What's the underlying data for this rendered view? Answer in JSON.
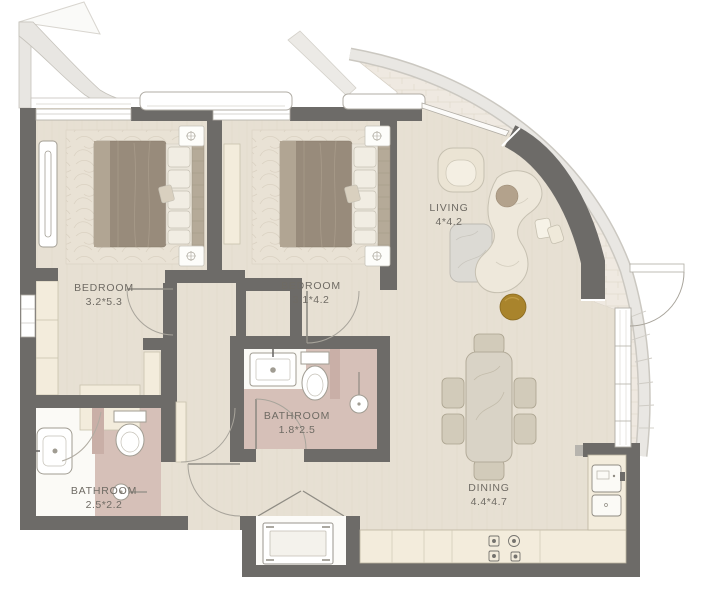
{
  "title": "Two-bedroom apartment floor plan",
  "rooms": {
    "bedroom1": {
      "label": "BEDROOM",
      "dims": "3.2*5.3"
    },
    "bedroom2": {
      "label": "BEDROOM",
      "dims": "3.1*4.2"
    },
    "living": {
      "label": "LIVING",
      "dims": "4*4.2"
    },
    "bathroom1": {
      "label": "BATHROOM",
      "dims": "1.8*2.5"
    },
    "bathroom2": {
      "label": "BATHROOM",
      "dims": "2.5*2.2"
    },
    "dining": {
      "label": "DINING",
      "dims": "4.4*4.7"
    }
  },
  "furniture": {
    "bedrooms": [
      "double-bed",
      "nightstands",
      "area-rug",
      "wardrobe",
      "window-seat"
    ],
    "living": [
      "armchair",
      "curved-sofa",
      "coffee-table",
      "side-tables",
      "gold-ottoman"
    ],
    "dining": [
      "dining-table",
      "six-chairs"
    ],
    "kitchen": [
      "counter-run",
      "cooktop-4-burners",
      "oven-column",
      "washing-machine"
    ],
    "bathroom1": [
      "sink",
      "toilet",
      "shower-with-drain"
    ],
    "bathroom2": [
      "sink",
      "toilet",
      "shower-enclosure",
      "shower-head"
    ],
    "outdoor": [
      "curved-balcony",
      "parapet",
      "canopy-edge",
      "balcony-door"
    ]
  },
  "colors": {
    "wall": "#6d6b68",
    "floor": "#e7e0d3",
    "bath-floor": "#d6c0b8",
    "bath-wall": "#c9afa7",
    "cream": "#f3ecdc",
    "balcony": "#efe9e1",
    "parapet": "#e9e7e3",
    "gold": "#a9842c",
    "duvet": "#988b7b",
    "marble": "#dcdad4",
    "label": "#6f6b64"
  }
}
